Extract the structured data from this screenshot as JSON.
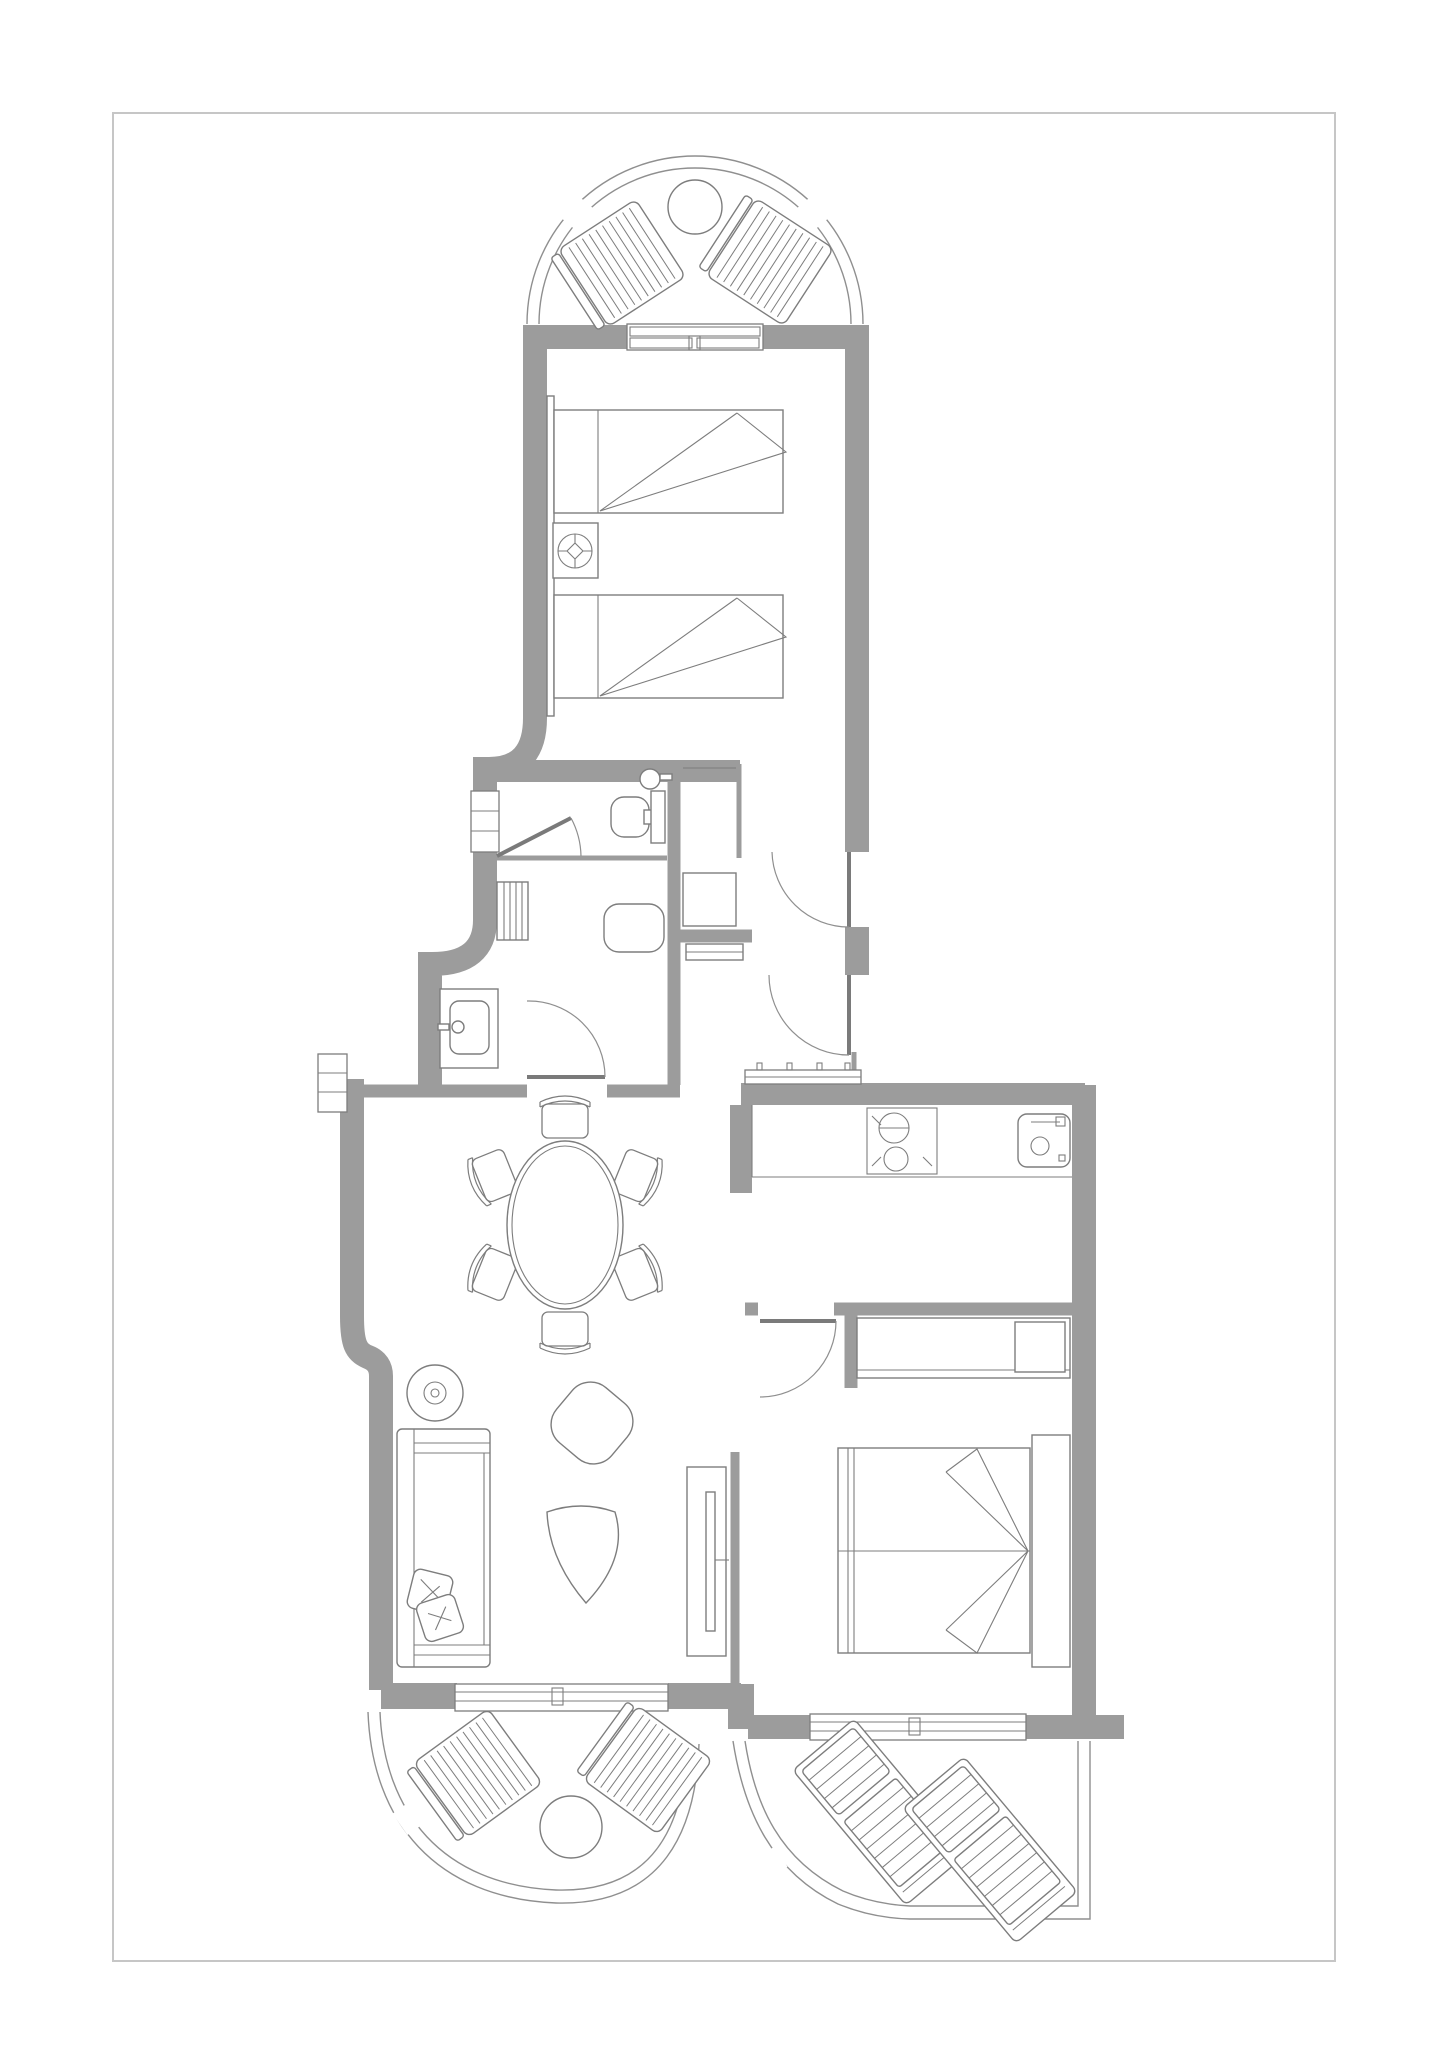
{
  "plan": {
    "label": "apartment-floor-plan",
    "drawing_type": "top-down architectural floor plan, monochrome line drawing, no text labels",
    "rooms": [
      {
        "name": "terrace-top",
        "shape": "semicircular",
        "furniture": [
          "sun-lounger",
          "sun-lounger",
          "round-table"
        ],
        "openings": [
          "railing"
        ]
      },
      {
        "name": "twin-bedroom",
        "shape": "rectangular",
        "furniture": [
          "single-bed",
          "single-bed",
          "nightstand-with-lamp",
          "headboard-panel"
        ],
        "openings": [
          "sliding-door-to-terrace"
        ]
      },
      {
        "name": "bathroom",
        "shape": "rectangular-split",
        "furniture": [
          "toilet-with-cistern",
          "corner-washbasin",
          "radiator",
          "bidet",
          "vanity-washbasin"
        ],
        "openings": [
          "window",
          "door-from-dining",
          "inner-wc-door"
        ]
      },
      {
        "name": "entrance-hall",
        "shape": "rectangular",
        "furniture": [
          "closet",
          "shelf",
          "doormat"
        ],
        "openings": [
          "entrance-door",
          "hall-passage-door"
        ]
      },
      {
        "name": "kitchen",
        "shape": "rectangular",
        "furniture": [
          "counter",
          "two-burner-hob",
          "kitchen-sink"
        ],
        "openings": [
          "service-window"
        ]
      },
      {
        "name": "dining-area",
        "shape": "open-plan",
        "furniture": [
          "oval-dining-table",
          "chair",
          "chair",
          "chair",
          "chair",
          "chair",
          "chair"
        ],
        "openings": []
      },
      {
        "name": "living-area",
        "shape": "open-plan",
        "furniture": [
          "sofa",
          "cushion",
          "cushion",
          "floor-lamp",
          "armchair",
          "coffee-table",
          "tv-cabinet"
        ],
        "openings": [
          "sliding-door-to-terrace",
          "small-window"
        ]
      },
      {
        "name": "double-bedroom",
        "shape": "rectangular",
        "furniture": [
          "double-bed",
          "headboard-panel",
          "wardrobe",
          "safe"
        ],
        "openings": [
          "door",
          "sliding-door-to-terrace"
        ]
      },
      {
        "name": "terrace-bottom-left",
        "shape": "semicircular",
        "furniture": [
          "sun-lounger",
          "sun-lounger",
          "round-table"
        ],
        "openings": [
          "railing"
        ]
      },
      {
        "name": "terrace-bottom-right",
        "shape": "curved-corner",
        "furniture": [
          "recliner-lounger",
          "recliner-lounger"
        ],
        "openings": [
          "railing"
        ]
      }
    ],
    "counts": {
      "bedrooms": 2,
      "bathrooms": 1,
      "terraces": 3,
      "dining-chairs": 6,
      "sun-loungers": 6
    }
  },
  "colors": {
    "bg": "#ffffff",
    "wall": "#9c9c9c",
    "line": "#7d7d7d",
    "railing": "#8f8f8f",
    "door": "#7a7a7a",
    "border": "#c6c6c6"
  }
}
